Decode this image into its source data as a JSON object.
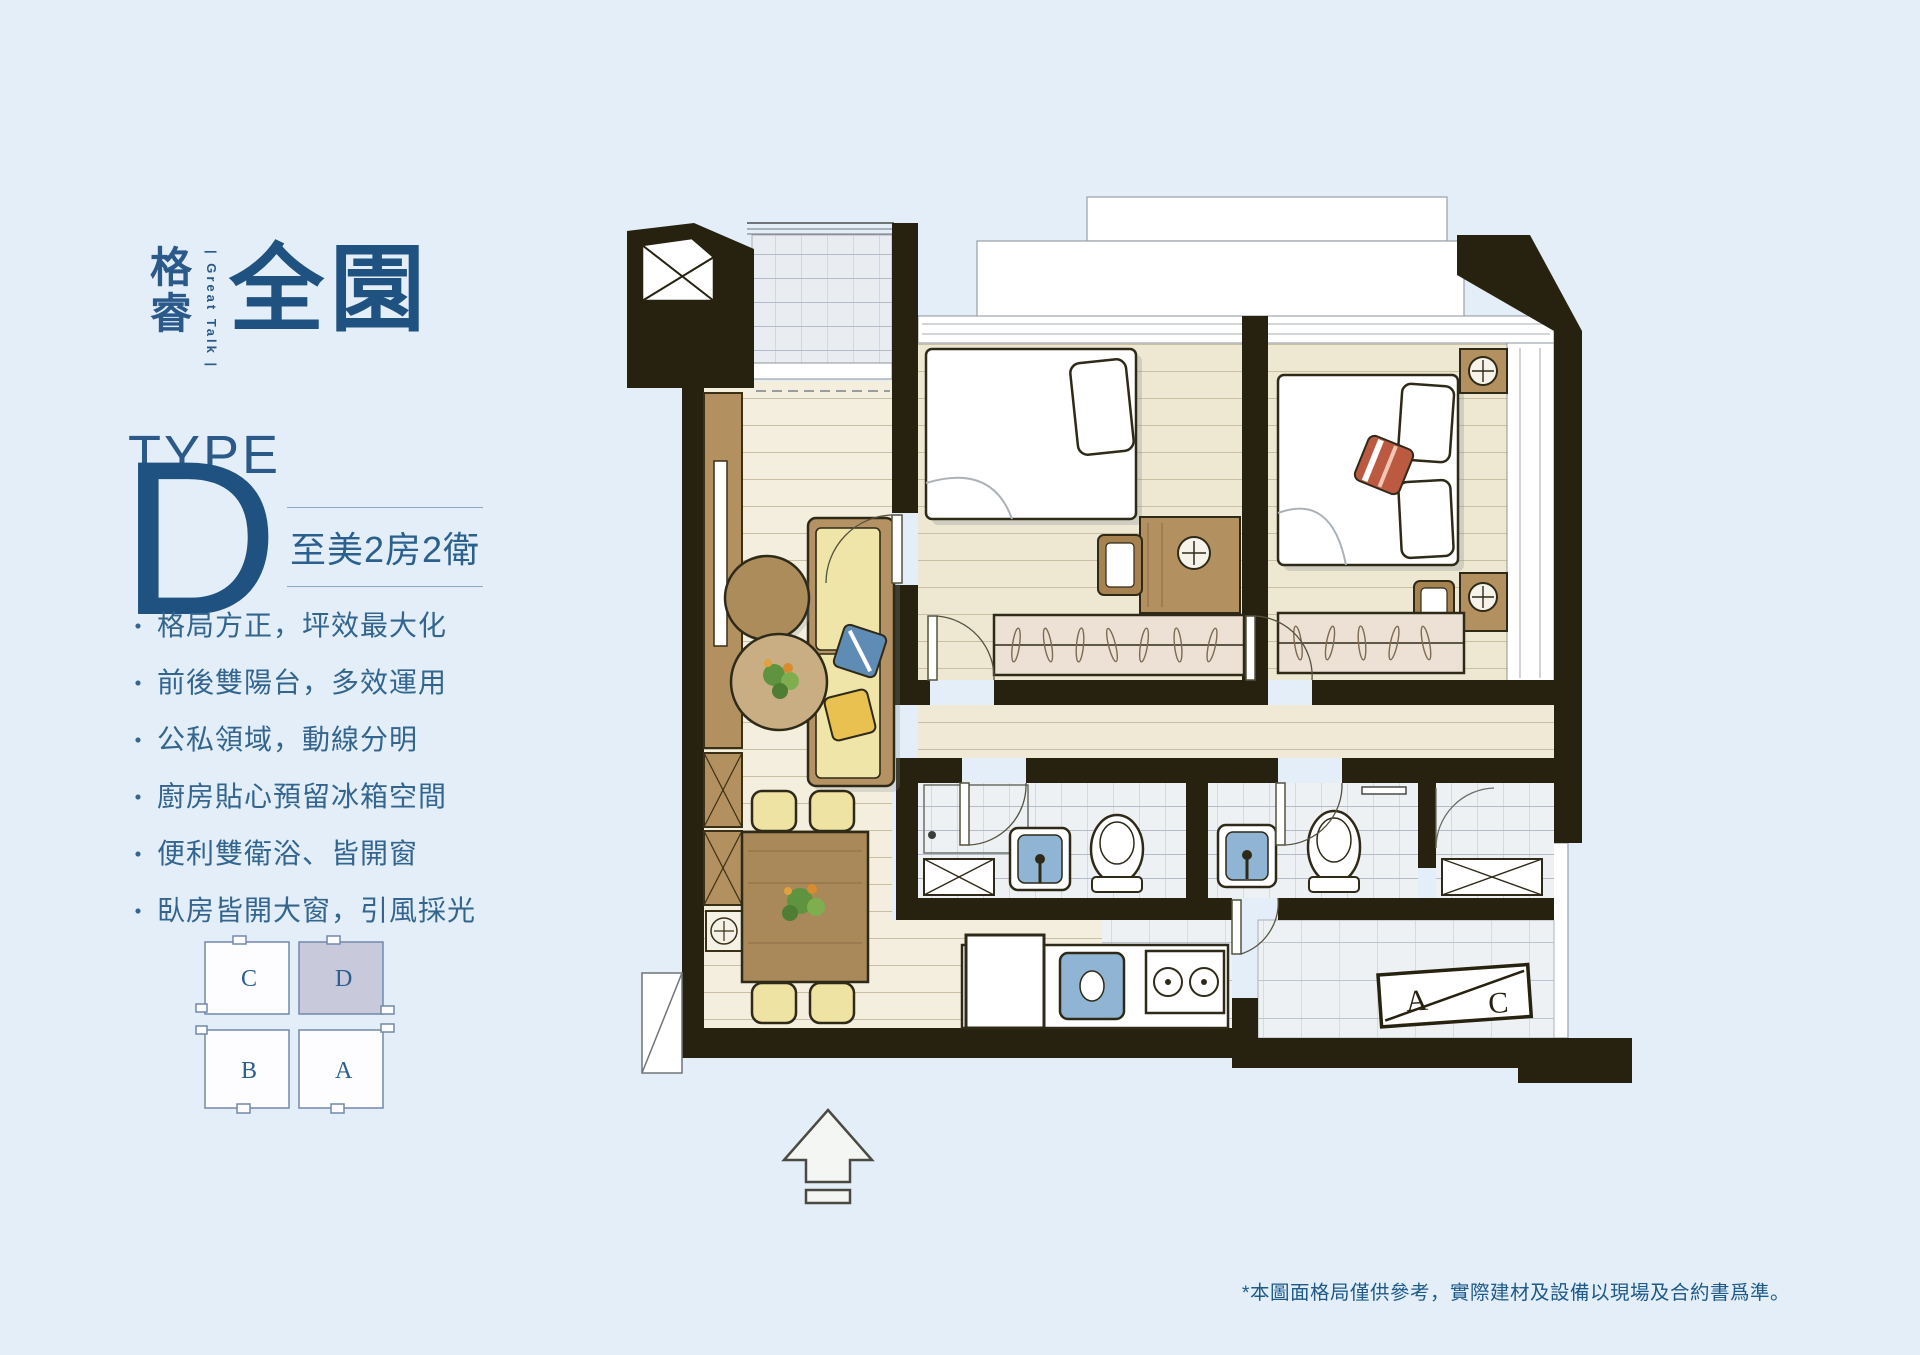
{
  "brand": {
    "name_top": "格",
    "name_bottom": "睿",
    "tagline": "| Great Talk |",
    "logotype": "全園"
  },
  "unit": {
    "type_label": "TYPE",
    "type_letter": "D",
    "subtitle": "至美2房2衛"
  },
  "bullet": "・",
  "features": [
    "格局方正，坪效最大化",
    "前後雙陽台，多效運用",
    "公私領域，動線分明",
    "廚房貼心預留冰箱空間",
    "便利雙衛浴、皆開窗",
    "臥房皆開大窗，引風採光"
  ],
  "keyplan": {
    "unit_c": "C",
    "unit_d": "D",
    "unit_b": "B",
    "unit_a": "A",
    "highlighted_unit": "D",
    "highlight_color": "#c9c9dc"
  },
  "plan": {
    "ac_a": "A",
    "ac_c": "C"
  },
  "disclaimer": "*本圖面格局僅供參考，實際建材及設備以現場及合約書爲準。",
  "colors": {
    "background": "#e3eef8",
    "brand_blue": "#2a598a",
    "deep_blue": "#1f5280",
    "wall": "#26220f",
    "floor_wood": "#f2eedd",
    "tile": "#e9edf2",
    "cabinet_wood": "#b3905f",
    "sofa_yellow": "#f0e5a9",
    "fixture_blue": "#8fb4d4",
    "pillow_red": "#bb5a41"
  }
}
